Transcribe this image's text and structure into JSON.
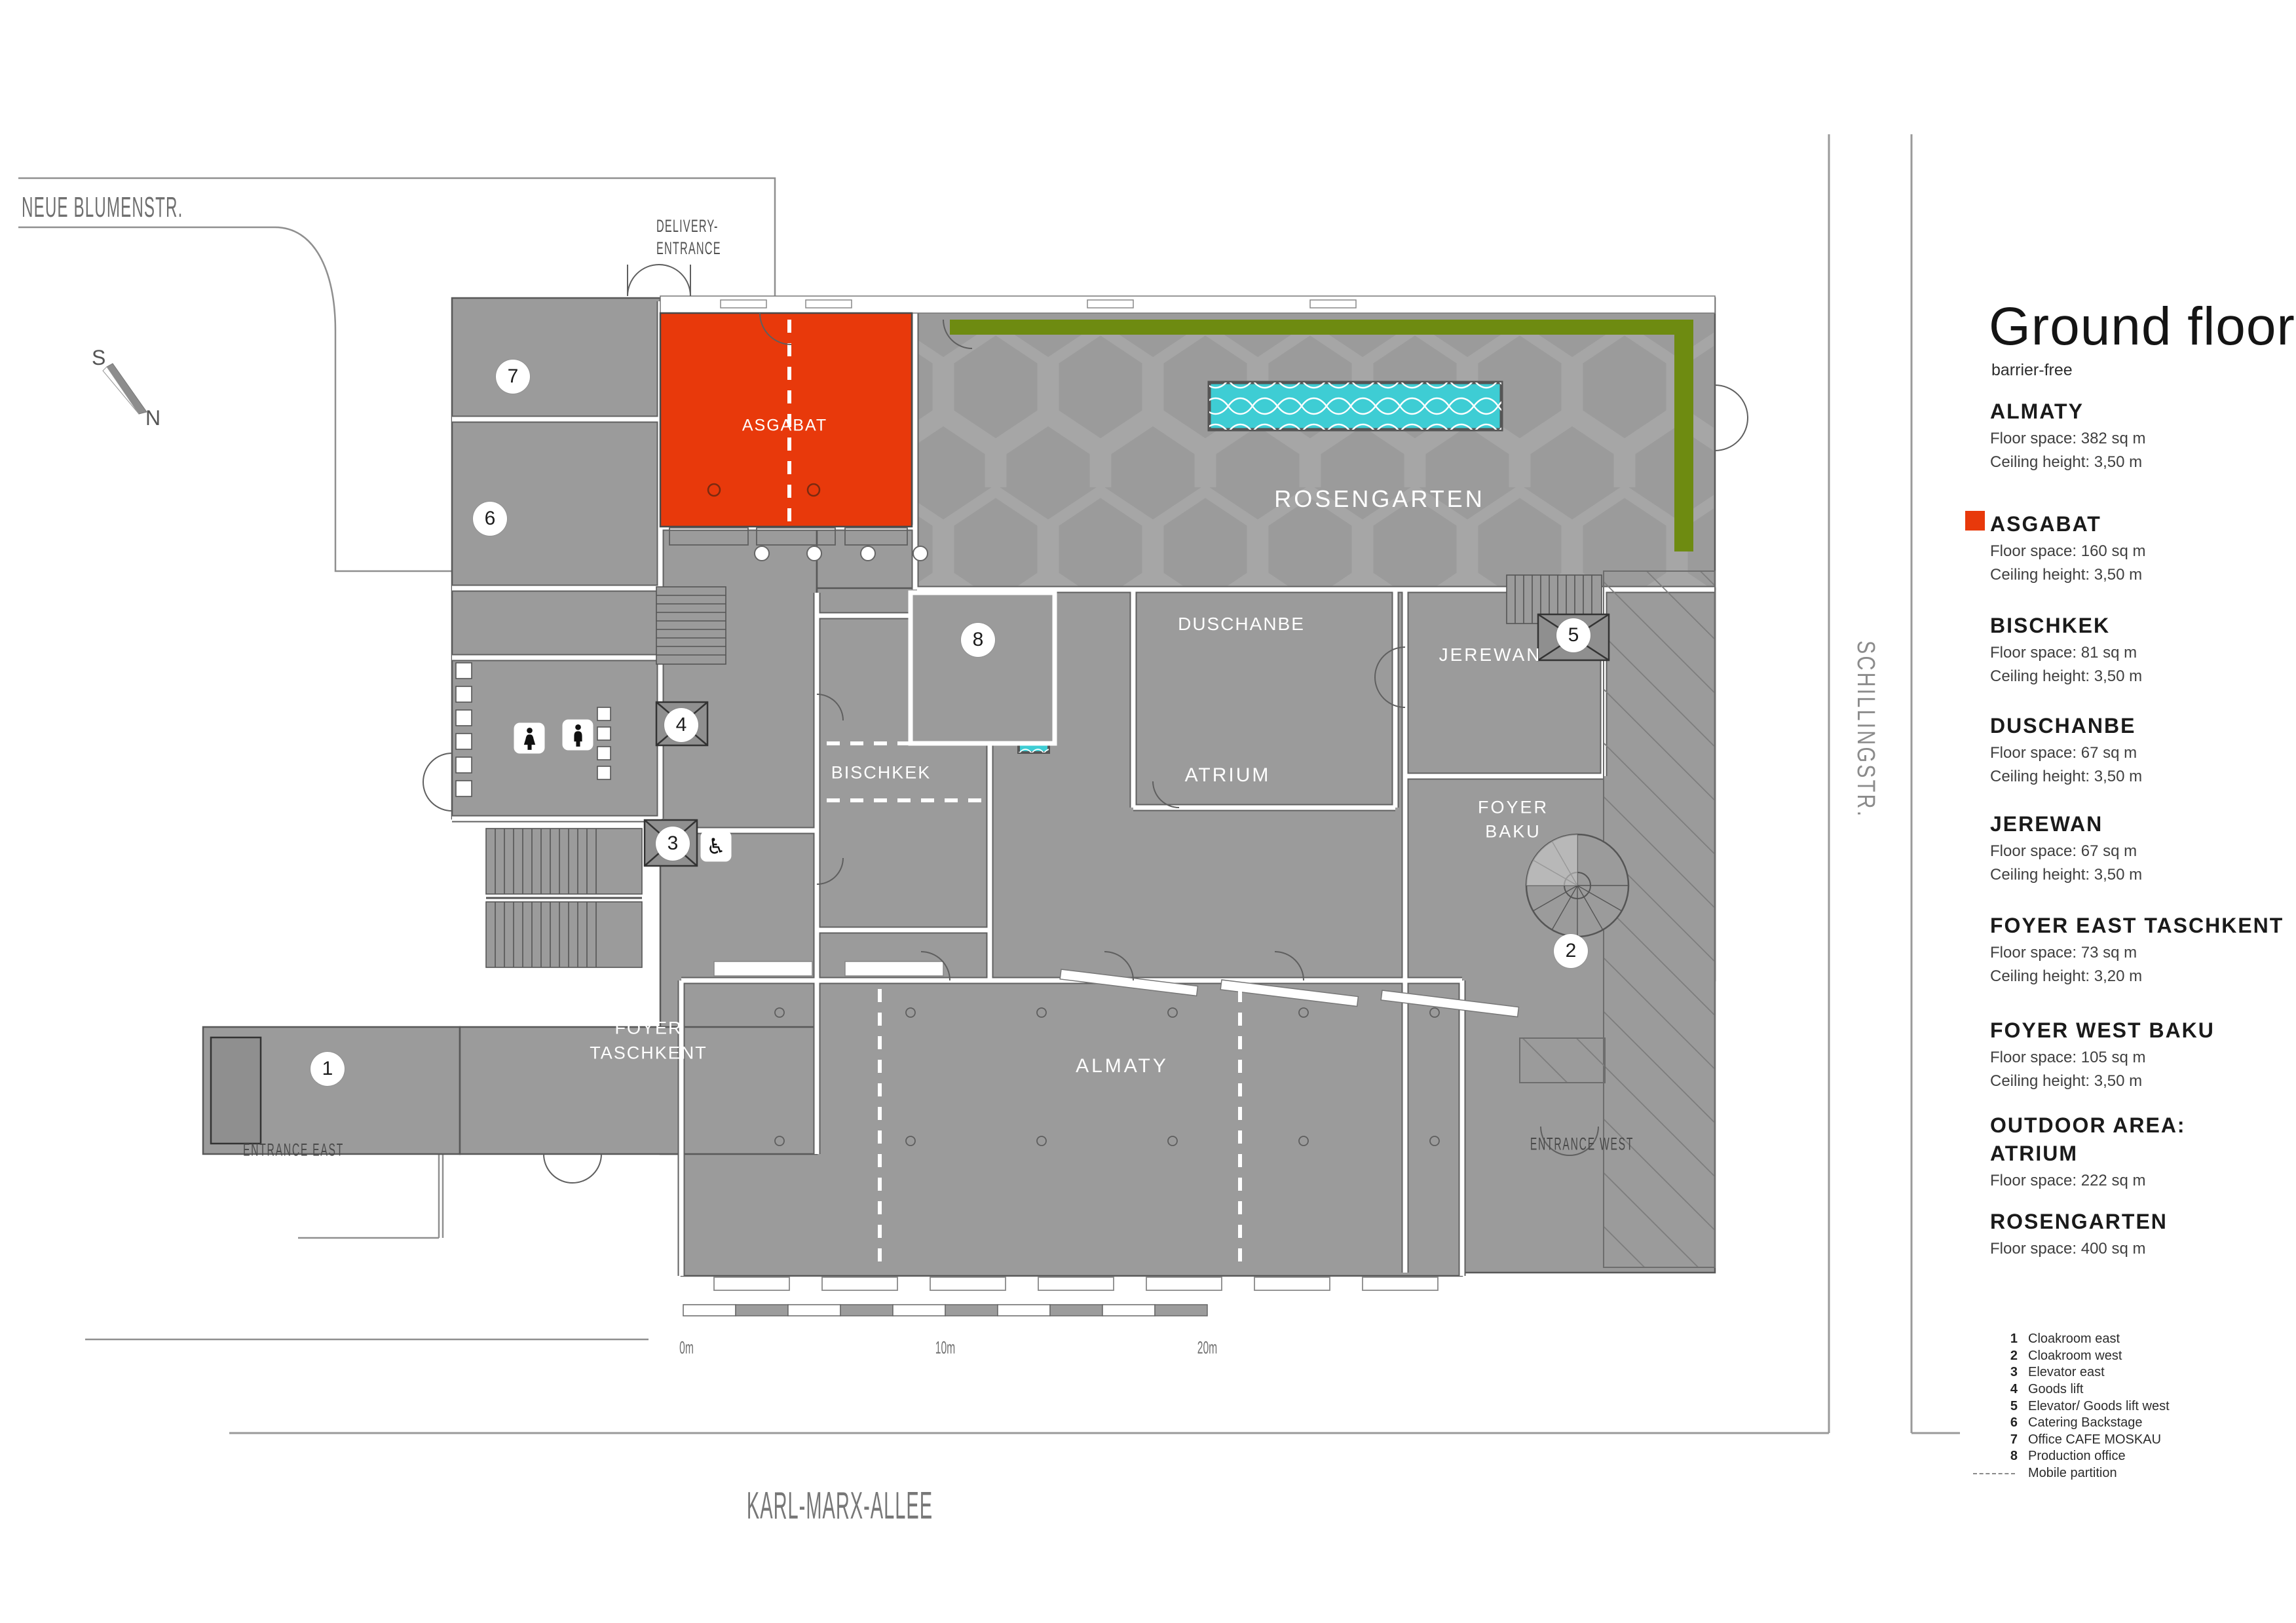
{
  "title": "Ground floor",
  "subtitle": "barrier-free",
  "streets": {
    "top": "NEUE BLUMENSTR.",
    "right": "SCHILLINGSTR.",
    "bottom": "KARL-MARX-ALLEE"
  },
  "entrances": {
    "delivery_line1": "DELIVERY-",
    "delivery_line2": "ENTRANCE",
    "east": "ENTRANCE EAST",
    "west": "ENTRANCE WEST"
  },
  "compass": {
    "south": "S",
    "north": "N"
  },
  "scalebar": {
    "t0": "0m",
    "t10": "10m",
    "t20": "20m"
  },
  "plan": {
    "rooms": {
      "asgabat": "ASGABAT",
      "rosengarten": "ROSENGARTEN",
      "duschanbe": "DUSCHANBE",
      "jerewan": "JEREWAN",
      "bischkek": "BISCHKEK",
      "atrium": "ATRIUM",
      "almaty": "ALMATY",
      "foyer_baku_line1": "FOYER",
      "foyer_baku_line2": "BAKU",
      "foyer_taschkent_line1": "FOYER",
      "foyer_taschkent_line2": "TASCHKENT"
    }
  },
  "legend": {
    "rooms": [
      {
        "name": "ALMATY",
        "floor": "Floor space: 382 sq m",
        "ceiling": "Ceiling height: 3,50 m"
      },
      {
        "name": "ASGABAT",
        "floor": "Floor space: 160 sq m",
        "ceiling": "Ceiling height: 3,50 m"
      },
      {
        "name": "BISCHKEK",
        "floor": "Floor space: 81 sq m",
        "ceiling": "Ceiling height: 3,50 m"
      },
      {
        "name": "DUSCHANBE",
        "floor": "Floor space: 67 sq m",
        "ceiling": "Ceiling height: 3,50 m"
      },
      {
        "name": "JEREWAN",
        "floor": "Floor space: 67 sq m",
        "ceiling": "Ceiling height: 3,50 m"
      },
      {
        "name": "FOYER EAST TASCHKENT",
        "floor": "Floor space: 73 sq m",
        "ceiling": "Ceiling height: 3,20 m"
      },
      {
        "name": "FOYER WEST BAKU",
        "floor": "Floor space: 105 sq m",
        "ceiling": "Ceiling height: 3,50 m"
      },
      {
        "name": "OUTDOOR AREA:",
        "name2": "ATRIUM",
        "floor": "Floor space: 222 sq m"
      },
      {
        "name": "ROSENGARTEN",
        "floor": "Floor space: 400 sq m"
      }
    ],
    "items": [
      {
        "num": "1",
        "label": "Cloakroom east"
      },
      {
        "num": "2",
        "label": "Cloakroom west"
      },
      {
        "num": "3",
        "label": "Elevator east"
      },
      {
        "num": "4",
        "label": "Goods lift"
      },
      {
        "num": "5",
        "label": "Elevator/ Goods lift west"
      },
      {
        "num": "6",
        "label": "Catering Backstage"
      },
      {
        "num": "7",
        "label": "Office CAFE MOSKAU"
      },
      {
        "num": "8",
        "label": "Production office"
      }
    ],
    "mobile_partition": "Mobile partition"
  },
  "colors": {
    "highlight_red": "#E8390B",
    "olive_green": "#6E8B11",
    "pool_cyan": "#3ECDD4",
    "room_gray": "#9B9B9B"
  }
}
